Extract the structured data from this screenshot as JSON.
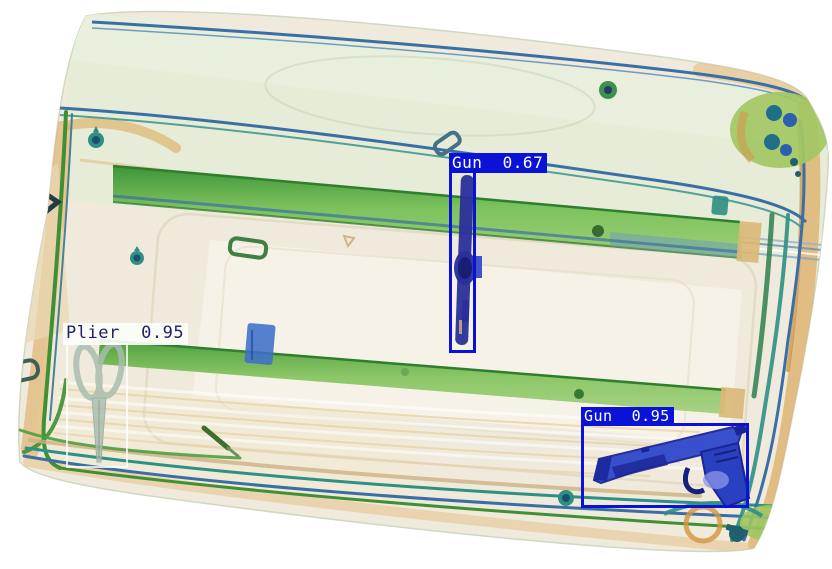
{
  "scene": {
    "type": "xray-baggage-scan",
    "background": "#ffffff",
    "palette": {
      "case_shell": "#efeadb",
      "case_green_tint": "#e4ecd6",
      "strap_green": "#5cb04a",
      "rim_orange": "#dcaa60",
      "tube_blue": "#3a6fa5",
      "tube_teal": "#2e8f85",
      "wheel_green": "#a3c763",
      "dense_object_blue": "#2a2f9a",
      "detection_blue": "#0a12d8"
    }
  },
  "detections": [
    {
      "id": "gun-1",
      "label": "Gun",
      "score": 0.67,
      "text": "Gun  0.67",
      "box": {
        "x": 449,
        "y": 170,
        "w": 27,
        "h": 183
      },
      "box_color": "#0a12d8",
      "border_px": 3,
      "label_bg": "#0a12d8",
      "label_fg": "#ffffff",
      "label_dx": 0,
      "font_px": 16
    },
    {
      "id": "plier-1",
      "label": "Plier",
      "score": 0.95,
      "text": "Plier  0.95",
      "box": {
        "x": 66,
        "y": 343,
        "w": 62,
        "h": 125
      },
      "box_color": "rgba(255,255,255,0.78)",
      "border_px": 2,
      "label_bg": "rgba(253,253,250,0.92)",
      "label_fg": "#21216f",
      "label_dx": -3,
      "font_px": 17
    },
    {
      "id": "gun-2",
      "label": "Gun",
      "score": 0.95,
      "text": "Gun  0.95",
      "box": {
        "x": 581,
        "y": 423,
        "w": 168,
        "h": 85
      },
      "box_color": "#0a12d8",
      "border_px": 3,
      "label_bg": "#0a12d8",
      "label_fg": "#ffffff",
      "label_dx": 0,
      "font_px": 15
    }
  ]
}
